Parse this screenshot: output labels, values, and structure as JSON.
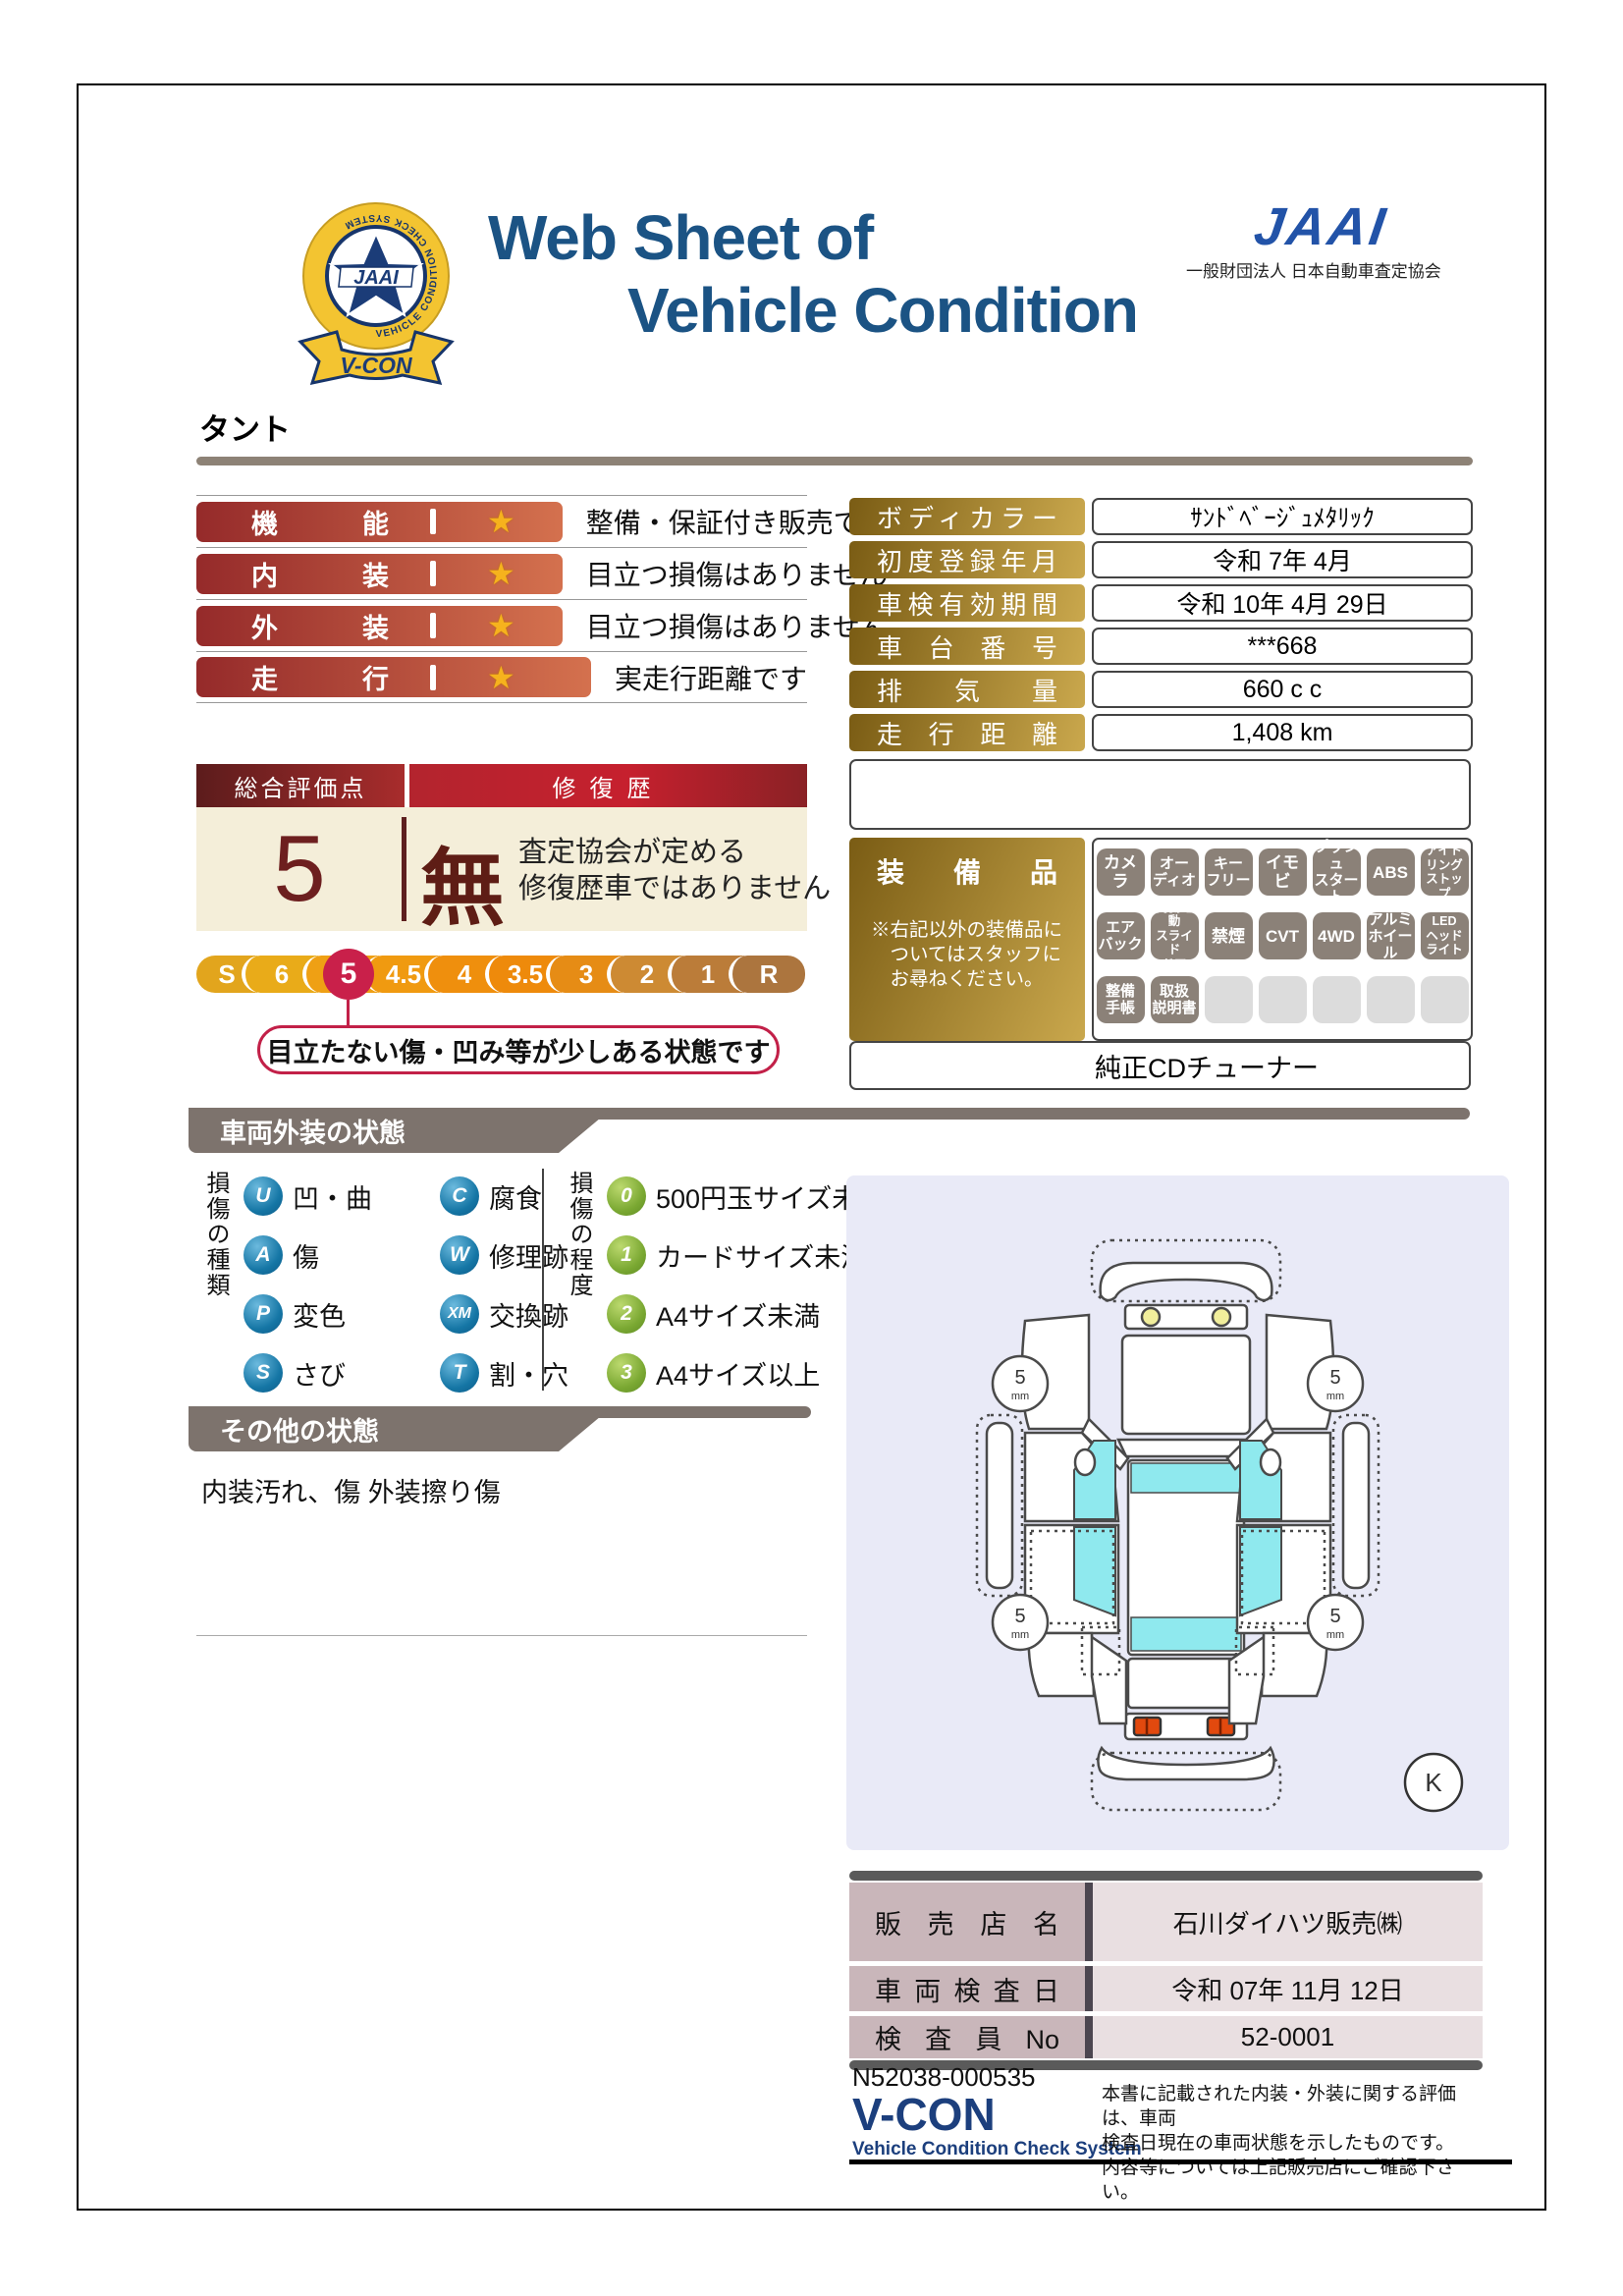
{
  "header": {
    "title_line1": "Web Sheet of",
    "title_line2": "Vehicle Condition",
    "emblem": {
      "jaai": "JAAI",
      "ring_text": "VEHICLE CONDITION CHECK SYSTEM",
      "ribbon": "V-CON"
    },
    "jaai_logo": "JAAI",
    "jaai_subtitle": "一般財団法人 日本自動車査定協会"
  },
  "vehicle_name": "タント",
  "ratings": [
    {
      "label": "機能",
      "desc": "整備・保証付き販売です"
    },
    {
      "label": "内装",
      "desc": "目立つ損傷はありません"
    },
    {
      "label": "外装",
      "desc": "目立つ損傷はありません"
    },
    {
      "label": "走行",
      "desc": "実走行距離です"
    }
  ],
  "overall": {
    "score_header": "総合評価点",
    "repair_header": "修復歴",
    "score": "5",
    "repair_value": "無",
    "repair_desc_line1": "査定協会が定める",
    "repair_desc_line2": "修復歴車ではありません",
    "callout": "目立たない傷・凹み等が少しある状態です",
    "selected": "5",
    "scale": [
      {
        "label": "S",
        "color": "#e2a51d",
        "selected": false
      },
      {
        "label": "6",
        "color": "#e9ab19",
        "selected": false
      },
      {
        "label": "5",
        "color": "#efa014",
        "selected": true
      },
      {
        "label": "4.5",
        "color": "#f09a10",
        "selected": false
      },
      {
        "label": "4",
        "color": "#ef8f0d",
        "selected": false
      },
      {
        "label": "3.5",
        "color": "#ee8a0b",
        "selected": false
      },
      {
        "label": "3",
        "color": "#e68c15",
        "selected": false
      },
      {
        "label": "2",
        "color": "#cd8a33",
        "selected": false
      },
      {
        "label": "1",
        "color": "#bb7c39",
        "selected": false
      },
      {
        "label": "R",
        "color": "#ac753e",
        "selected": false
      }
    ],
    "selected_color": "#c9204a"
  },
  "details": {
    "rows": [
      {
        "label": "ボディカラー",
        "value": "ｻﾝﾄﾞﾍﾞｰｼﾞｭﾒﾀﾘｯｸ"
      },
      {
        "label": "初度登録年月",
        "value": "令和 7年 4月"
      },
      {
        "label": "車検有効期間",
        "value": "令和 10年 4月 29日"
      },
      {
        "label": "車台番号",
        "value": "***668"
      },
      {
        "label": "排気量",
        "value": "660 c c"
      },
      {
        "label": "走行距離",
        "value": "1,408 km"
      }
    ]
  },
  "equipment": {
    "header": "装備品",
    "note": "※右記以外の装備品に\n　ついてはスタッフに\n　お尋ねください。",
    "badges": [
      {
        "lines": [
          "カメラ"
        ]
      },
      {
        "lines": [
          "オー",
          "ディオ"
        ]
      },
      {
        "lines": [
          "キー",
          "フリー"
        ]
      },
      {
        "lines": [
          "イモビ"
        ]
      },
      {
        "lines": [
          "プッシュ",
          "スタート"
        ]
      },
      {
        "lines": [
          "ABS"
        ]
      },
      {
        "lines": [
          "アイド",
          "リング",
          "ストップ"
        ]
      },
      {
        "lines": [
          "エア",
          "バック"
        ]
      },
      {
        "lines": [
          "両側電動",
          "スライド",
          "ドア"
        ]
      },
      {
        "lines": [
          "禁煙"
        ]
      },
      {
        "lines": [
          "CVT"
        ]
      },
      {
        "lines": [
          "4WD"
        ]
      },
      {
        "lines": [
          "アルミ",
          "ホイール"
        ]
      },
      {
        "lines": [
          "LED",
          "ヘッド",
          "ライト"
        ]
      },
      {
        "lines": [
          "整備",
          "手帳"
        ]
      },
      {
        "lines": [
          "取扱",
          "説明書"
        ]
      },
      null,
      null,
      null,
      null,
      null
    ],
    "extra": "純正CDチューナー"
  },
  "exterior_section": {
    "tab": "車両外装の状態",
    "kind_label": "損傷の種類",
    "kinds": [
      {
        "code": "U",
        "label": "凹・曲"
      },
      {
        "code": "C",
        "label": "腐食"
      },
      {
        "code": "A",
        "label": "傷"
      },
      {
        "code": "W",
        "label": "修理跡"
      },
      {
        "code": "P",
        "label": "変色"
      },
      {
        "code": "XM",
        "label": "交換跡"
      },
      {
        "code": "S",
        "label": "さび"
      },
      {
        "code": "T",
        "label": "割・穴"
      }
    ],
    "degree_label": "損傷の程度",
    "degrees": [
      {
        "code": "0",
        "label": "500円玉サイズ未満"
      },
      {
        "code": "1",
        "label": "カードサイズ未満"
      },
      {
        "code": "2",
        "label": "A4サイズ未満"
      },
      {
        "code": "3",
        "label": "A4サイズ以上"
      }
    ]
  },
  "other_section": {
    "tab": "その他の状態",
    "text": "内装汚れ、傷 外装擦り傷"
  },
  "diagram": {
    "wheel_value": "5",
    "wheel_unit": "mm",
    "corner_mark": "K"
  },
  "dealer": {
    "rows": [
      {
        "label": "販売店名",
        "value": "石川ダイハツ販売㈱"
      },
      {
        "label": "車両検査日",
        "value": "令和 07年 11月 12日"
      },
      {
        "label": "検査員No",
        "value": "52-0001"
      }
    ]
  },
  "footer": {
    "doc_number": "N52038-000535",
    "vcon": "V-CON",
    "vcon_sub": "Vehicle Condition Check System",
    "disclaimer_line1": "本書に記載された内装・外装に関する評価は、車両",
    "disclaimer_line2": "検査日現在の車両状態を示したものです。",
    "disclaimer_line3": "内容等については上記販売店にご確認下さい。"
  }
}
